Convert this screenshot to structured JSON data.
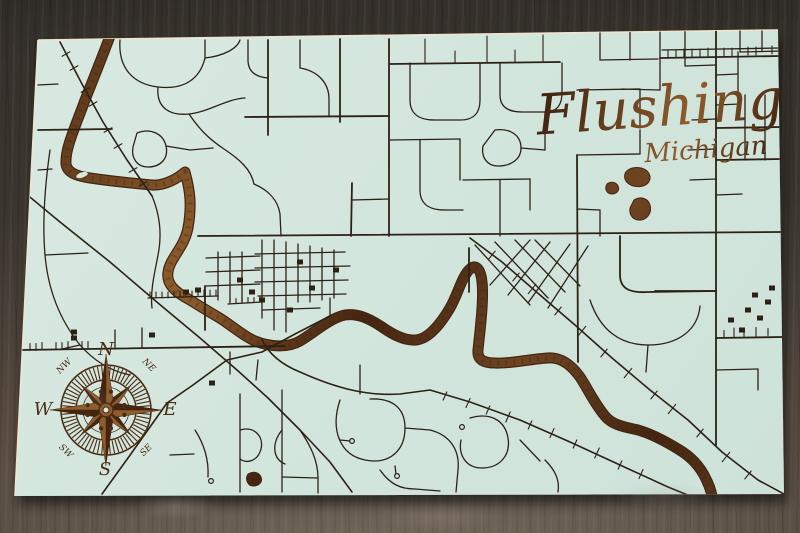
{
  "title": {
    "text": "Flushing",
    "subtext": "Michigan"
  },
  "compass": {
    "cx": 106,
    "cy": 410,
    "ring_outer": 45,
    "ring_inner": 30,
    "inner_circle": 23,
    "tick_outer": 44,
    "tick_inner": 31,
    "n_ticks": 64,
    "star_long": 56,
    "star_long_half": 7,
    "star_short": 36,
    "star_short_half": 5,
    "hub_r": 7,
    "hub_hole": 3,
    "dot_r": 2.2,
    "dot_ring": 19,
    "dot_angles": [
      15,
      75,
      105,
      165,
      195,
      255,
      285,
      345
    ],
    "labels": {
      "n": "N",
      "e": "E",
      "s": "S",
      "w": "W",
      "ne": "NE",
      "nw": "NW",
      "se": "SE",
      "sw": "SW"
    }
  },
  "colors": {
    "board": "#d8e9e1",
    "board_shade": "#cde2d8",
    "edge_light": "#efe5cf",
    "street": "#2d2115",
    "wood_dark": "#432511",
    "wood_mid": "#6e4522",
    "wood_light": "#8f5d2c",
    "compass_brown": "#4a2c14",
    "shadow": "#000000"
  },
  "map": {
    "board_polygon": "38,40 778,30 784,494 15,496",
    "river": "M113,28 C105,50 95,75 85,100 C75,128 65,148 66,164 C67,172 75,176 90,178 C110,181 130,183 152,185 C165,186 178,178 185,172 C190,190 192,205 188,228 C184,248 170,258 168,272 C166,284 175,292 190,300 C198,305 206,310 218,317 C230,324 243,336 255,341 C270,347 288,348 300,341 C315,332 330,318 345,315 C358,313 370,319 382,327 C392,334 404,341 416,340 C428,339 440,325 450,308 C458,294 462,276 470,269 C476,263 481,270 482,282 C484,300 480,330 478,350 C477,360 484,363 495,363 C510,364 530,359 548,358 C562,357 572,366 580,377 C588,389 594,403 605,416 C612,425 625,427 638,430 C652,434 665,441 678,449 C690,456 700,466 706,479 C710,487 711,491 712,496",
    "island": {
      "cx": 82,
      "cy": 175,
      "rx": 6,
      "ry": 2.6,
      "rot": -18
    },
    "ponds": [
      "M628,170 C634,166 644,167 648,172 C652,177 650,184 643,186 C635,188 627,185 625,179 C624,175 625,172 628,170 Z",
      "M607,184 C611,181 616,182 618,186 C620,190 617,194 612,194 C607,194 604,189 607,184 Z",
      "M634,200 C640,196 648,198 650,205 C652,212 648,219 641,220 C634,221 629,216 630,208 Z",
      "M248,474 C253,471 259,472 261,477 C263,482 259,486 253,486 C247,486 245,478 248,474 Z"
    ],
    "arterials": [
      "M198,236 L782,232",
      "M38,130 L112,129",
      "M20,350 L285,346",
      "M716,31 L716,445",
      "M389,39 L389,236",
      "M352,183 L351,236",
      "M268,40 L268,135",
      "M340,39 L340,122",
      "M577,155 L578,362",
      "M390,64 L560,62",
      "M245,117 L389,116",
      "M660,58 L780,56",
      "M716,128 L783,127",
      "M716,160 L783,159",
      "M655,291 L716,291",
      "M716,338 L783,337",
      "M620,236 L620,275 C620,290 632,293 648,292 L716,291",
      "M205,286 L205,330",
      "M469,248 L469,292"
    ],
    "diagonals": [
      "M60,42 L82,84 L103,122 L127,160 L152,196",
      "M13,183 L60,222 L110,262 L158,303 L200,338 L237,370 L268,398 L300,430 L330,462 L352,492",
      "M330,316 L295,334 L262,352 L227,360 L193,385 L167,403 L128,458 L102,494",
      "M470,238 L502,262 L540,295 L575,325 L612,358 L650,390 L688,420 L722,452 L758,480 L784,494",
      "M262,340 C268,352 280,364 300,372 C340,390 370,396 400,394 L430,390 L470,402 L520,420 L570,442 L620,465 L668,487 L690,496"
    ],
    "streets": [
      "M120,40 C118,68 133,84 158,87 C184,90 200,79 205,58 L205,40",
      "M205,58 C223,56 237,49 240,40",
      "M158,87 C156,108 170,116 189,114 C209,112 226,99 245,98",
      "M300,40 L300,68 C318,71 329,83 329,99 L329,116",
      "M248,40 L248,60 C248,72 256,77 268,78",
      "M137,133 C150,128 163,133 166,146 C169,159 160,167 148,167 C137,167 131,158 133,147 Z",
      "M166,146 L190,150 L213,148",
      "M189,114 C199,129 209,139 224,149 C239,159 251,169 254,184",
      "M254,184 C268,190 278,200 280,214 L281,236",
      "M38,85 L58,84",
      "M38,170 L52,169",
      "M50,150 C45,185 42,220 45,255 C48,290 60,320 80,345 C94,361 110,371 130,375",
      "M45,255 L88,253",
      "M152,196 C160,215 162,235 158,255 C155,272 150,290 152,308",
      "M80,345 L62,349",
      "M115,349 L115,330",
      "M142,348 L142,328",
      "M262,240 L262,318",
      "M274,240 L274,330",
      "M286,242 L286,332",
      "M298,244 L298,302",
      "M310,246 L310,302",
      "M322,248 L322,300",
      "M334,250 L334,298",
      "M255,254 L345,252",
      "M255,268 L350,266",
      "M255,282 L348,280",
      "M258,296 L346,294",
      "M262,310 L320,308",
      "M218,252 L218,300",
      "M230,252 L230,302",
      "M242,252 L242,302",
      "M206,258 L260,256",
      "M206,272 L260,270",
      "M206,286 L260,284",
      "M148,298 L218,296",
      "M228,304 L262,302",
      "M330,298 L330,316",
      "M410,63 L410,100 C410,115 420,120 435,120 L460,120 C475,120 480,112 480,100 L480,63",
      "M500,63 L500,95 C500,108 510,112 522,112 L545,112 C558,112 562,104 562,92 L562,63",
      "M390,140 L460,139",
      "M460,139 L460,180",
      "M420,140 L420,190 C420,205 430,210 445,210 L463,210",
      "M495,130 C510,128 521,135 521,148 C521,160 510,166 498,166 C487,166 481,157 483,146 Z",
      "M521,148 L545,150",
      "M545,112 L545,150",
      "M463,180 L530,179",
      "M530,179 L530,210",
      "M500,180 L500,236",
      "M352,200 L389,199",
      "M600,31 L600,60",
      "M600,60 L658,59",
      "M630,31 L630,60",
      "M660,32 L660,90",
      "M660,90 L622,89",
      "M685,31 L685,66",
      "M685,66 L716,65",
      "M740,30 L740,52",
      "M740,52 L783,51",
      "M762,31 L762,51",
      "M745,95 L745,160",
      "M765,95 L765,160",
      "M738,52 L738,92",
      "M662,50 L780,48",
      "M577,90 L640,89",
      "M640,89 L640,128",
      "M577,155 L640,154",
      "M640,154 L640,130",
      "M600,236 L600,210 L577,209",
      "M716,75 L738,74",
      "M716,105 L740,104",
      "M716,195 L742,194",
      "M692,120 L716,119",
      "M688,150 L716,149",
      "M690,180 L716,179",
      "M590,300 C600,330 620,345 648,345 C678,345 698,330 700,306",
      "M648,345 L646,372",
      "M716,370 L758,369",
      "M758,369 L758,390",
      "M475,245 L530,305",
      "M495,242 L548,298",
      "M515,240 L565,292",
      "M535,240 L580,286",
      "M530,240 L490,285",
      "M550,242 L508,295",
      "M570,244 L528,303",
      "M588,246 L548,308",
      "M340,400 C330,430 340,455 365,460 C390,465 405,450 405,428 C405,406 390,398 370,399",
      "M405,428 L430,430",
      "M430,430 C450,435 460,450 458,470 L456,492",
      "M470,418 C490,412 505,420 508,438 C511,456 499,468 482,468 C466,468 458,455 461,440",
      "M380,470 C390,484 400,489 415,489 L440,491",
      "M300,430 C310,445 318,460 318,478 L318,493",
      "M360,394 L360,365",
      "M545,460 C555,470 560,480 558,492",
      "M520,440 L540,461",
      "M240,394 L240,492",
      "M282,390 L282,492",
      "M240,430 C254,426 264,436 261,449 C258,461 247,464 240,459",
      "M282,430 C271,444 273,459 285,464",
      "M195,430 C204,444 209,459 208,477",
      "M170,455 L194,454",
      "M318,478 L282,477",
      "M230,352 L230,374",
      "M258,360 L256,380",
      "M340,440 L350,441",
      "M395,466 L396,474"
    ],
    "ticks": [
      [
        66,
        54,
        -30,
        9
      ],
      [
        74,
        68,
        -30,
        9
      ],
      [
        85,
        90,
        -30,
        9
      ],
      [
        93,
        104,
        -30,
        9
      ],
      [
        108,
        130,
        -30,
        9
      ],
      [
        118,
        146,
        -30,
        9
      ],
      [
        133,
        170,
        -30,
        9
      ],
      [
        143,
        184,
        -30,
        9
      ],
      [
        30,
        347,
        90,
        7
      ],
      [
        36,
        347,
        90,
        7
      ],
      [
        42,
        346,
        90,
        7
      ],
      [
        56,
        346,
        90,
        7
      ],
      [
        62,
        346,
        90,
        7
      ],
      [
        68,
        345,
        90,
        7
      ],
      [
        82,
        345,
        90,
        7
      ],
      [
        88,
        345,
        90,
        7
      ],
      [
        425,
        51,
        90,
        24
      ],
      [
        455,
        57,
        90,
        12
      ],
      [
        487,
        49,
        90,
        26
      ],
      [
        515,
        56,
        90,
        12
      ],
      [
        543,
        48,
        90,
        26
      ],
      [
        668,
        54,
        90,
        8
      ],
      [
        676,
        54,
        90,
        8
      ],
      [
        684,
        53,
        90,
        8
      ],
      [
        692,
        53,
        90,
        8
      ],
      [
        700,
        53,
        90,
        8
      ],
      [
        708,
        52,
        90,
        8
      ],
      [
        724,
        52,
        90,
        8
      ],
      [
        732,
        52,
        90,
        8
      ],
      [
        748,
        51,
        90,
        8
      ],
      [
        756,
        51,
        90,
        8
      ],
      [
        772,
        50,
        90,
        8
      ],
      [
        492,
        255,
        -51,
        10
      ],
      [
        516,
        277,
        -51,
        10
      ],
      [
        532,
        289,
        -51,
        12
      ],
      [
        558,
        311,
        -51,
        10
      ],
      [
        582,
        331,
        -51,
        12
      ],
      [
        604,
        353,
        -51,
        10
      ],
      [
        628,
        373,
        -51,
        12
      ],
      [
        654,
        395,
        -51,
        10
      ],
      [
        672,
        409,
        -51,
        12
      ],
      [
        700,
        433,
        -51,
        10
      ],
      [
        726,
        457,
        -51,
        12
      ],
      [
        748,
        475,
        -51,
        10
      ],
      [
        445,
        396,
        114,
        9
      ],
      [
        468,
        403,
        114,
        10
      ],
      [
        488,
        410,
        114,
        9
      ],
      [
        508,
        417,
        114,
        11
      ],
      [
        530,
        425,
        114,
        9
      ],
      [
        552,
        433,
        114,
        10
      ],
      [
        575,
        444,
        114,
        9
      ],
      [
        597,
        453,
        114,
        11
      ],
      [
        620,
        465,
        114,
        9
      ],
      [
        641,
        474,
        114,
        10
      ],
      [
        150,
        295,
        90,
        6
      ],
      [
        156,
        295,
        90,
        6
      ],
      [
        162,
        295,
        90,
        6
      ],
      [
        168,
        295,
        90,
        6
      ],
      [
        174,
        294,
        90,
        6
      ],
      [
        180,
        294,
        90,
        6
      ],
      [
        186,
        294,
        90,
        6
      ],
      [
        192,
        294,
        90,
        6
      ],
      [
        198,
        293,
        90,
        6
      ],
      [
        204,
        293,
        90,
        6
      ],
      [
        210,
        293,
        90,
        6
      ],
      [
        216,
        293,
        90,
        6
      ],
      [
        230,
        301,
        90,
        5
      ],
      [
        236,
        301,
        90,
        5
      ],
      [
        242,
        300,
        90,
        5
      ],
      [
        248,
        300,
        90,
        5
      ],
      [
        254,
        300,
        90,
        5
      ],
      [
        260,
        299,
        90,
        5
      ],
      [
        724,
        334,
        90,
        7
      ],
      [
        734,
        333,
        90,
        10
      ],
      [
        744,
        333,
        90,
        7
      ],
      [
        756,
        332,
        90,
        9
      ],
      [
        768,
        332,
        90,
        7
      ]
    ],
    "blocks": [
      [
        240,
        280
      ],
      [
        252,
        292
      ],
      [
        300,
        262
      ],
      [
        312,
        288
      ],
      [
        336,
        270
      ],
      [
        290,
        310
      ],
      [
        262,
        300
      ],
      [
        755,
        295
      ],
      [
        768,
        302
      ],
      [
        748,
        310
      ],
      [
        760,
        318
      ],
      [
        772,
        288
      ],
      [
        731,
        320
      ],
      [
        742,
        330
      ],
      [
        198,
        290
      ],
      [
        186,
        292
      ],
      [
        74,
        332
      ],
      [
        74,
        338
      ],
      [
        212,
        383
      ],
      [
        152,
        335
      ]
    ],
    "dots": [
      [
        352,
        441
      ],
      [
        397,
        476
      ],
      [
        211,
        481
      ],
      [
        462,
        427
      ]
    ]
  }
}
